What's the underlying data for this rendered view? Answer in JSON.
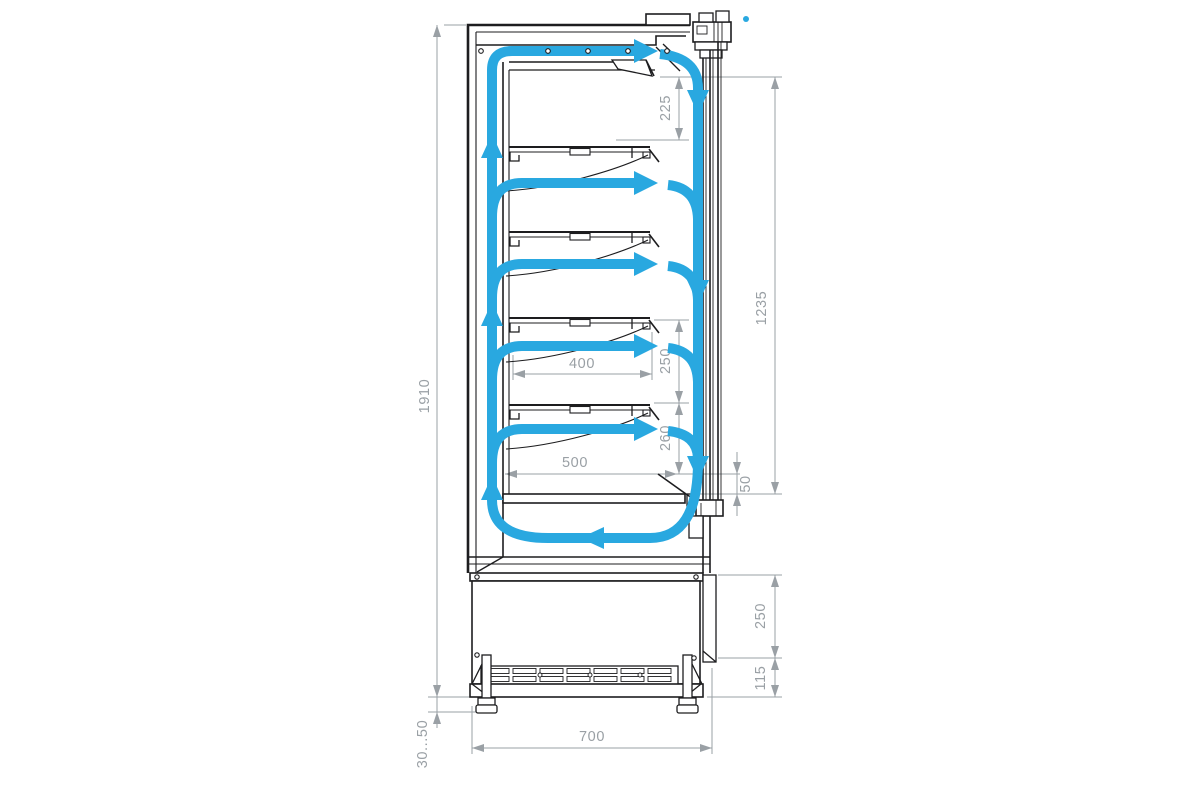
{
  "diagram": {
    "title": "refrigerated-display-case-side-section-with-airflow",
    "type": "technical-drawing",
    "dimensions": {
      "overall_height": "1910",
      "top_air_gap": "225",
      "front_opening_height": "1235",
      "shelf_pitch": "250",
      "shelf_to_deck_gap": "260",
      "shelf_depth": "400",
      "deck_depth": "500",
      "air_return_gap": "50",
      "machine_base_height": "250",
      "base_vent_height": "115",
      "foot_adjust_range": "30...50",
      "overall_depth": "700"
    },
    "colors": {
      "airflow_blue": "#29a8e0",
      "outline_dark": "#1d1d1f",
      "dimension_gray": "#9aa0a5",
      "background": "#ffffff"
    }
  }
}
